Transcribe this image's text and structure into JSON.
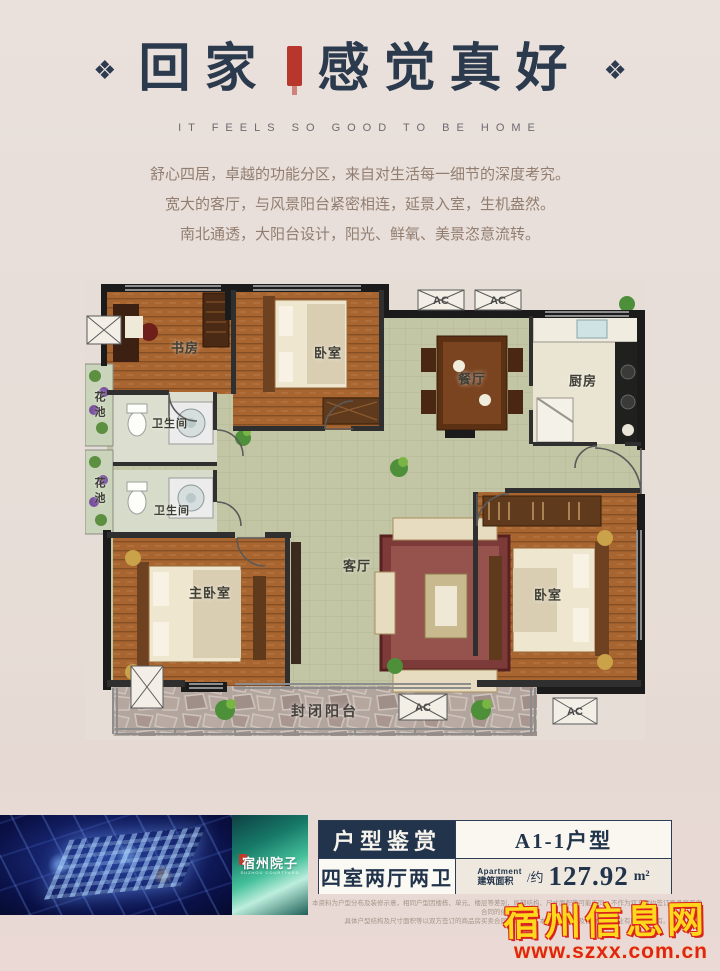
{
  "header": {
    "ornament": "❖",
    "title_left": "回家",
    "title_right": "感觉真好",
    "subtitle": "IT FEELS SO GOOD TO BE HOME"
  },
  "intro": {
    "lines": [
      "舒心四居，卓越的功能分区，来自对生活每一细节的深度考究。",
      "宽大的客厅，与风景阳台紧密相连，延景入室，生机盎然。",
      "南北通透，大阳台设计，阳光、鲜氧、美景恣意流转。"
    ]
  },
  "plan": {
    "ac_label": "AC",
    "rooms": [
      {
        "id": "study",
        "label": "书房"
      },
      {
        "id": "bedroom-top",
        "label": "卧室"
      },
      {
        "id": "dining",
        "label": "餐厅"
      },
      {
        "id": "kitchen",
        "label": "厨房"
      },
      {
        "id": "flower-pond-1",
        "label": "花池"
      },
      {
        "id": "bathroom-1",
        "label": "卫生间"
      },
      {
        "id": "flower-pond-2",
        "label": "花池"
      },
      {
        "id": "bathroom-2",
        "label": "卫生间"
      },
      {
        "id": "master-bedroom",
        "label": "主卧室"
      },
      {
        "id": "living",
        "label": "客厅"
      },
      {
        "id": "bedroom-right",
        "label": "卧室"
      },
      {
        "id": "balcony",
        "label": "封闭阳台"
      }
    ]
  },
  "footer": {
    "brand": {
      "name": "宿州院子",
      "caption": "SUZHOU COURTYARD"
    },
    "table": {
      "section_title": "户型鉴赏",
      "unit_type": "A1-1户型",
      "rooms_desc": "四室两厅两卫",
      "area_en": "Apartment",
      "area_cn": "建筑面积",
      "area_sep": "/约",
      "area_value": "127.92",
      "area_unit": "m²"
    },
    "disclaimer": [
      "本资料为户型分布及装修示意，相同户型因楼栋、单元、楼层等差别，局部结构、尺寸面积等可能不同，不作为双方履约签订商品房买卖合同的依据条款。",
      "具体户型结构及尺寸面积等以双方签订的商品房买卖合同约定为准，本资料解释权及修改权归置业有限公司所有。"
    ]
  },
  "watermark": {
    "site_name": "宿州信息网",
    "site_url": "www.szxx.com.cn"
  },
  "colors": {
    "accent_navy": "#22344b",
    "seal_red": "#b8372c",
    "watermark_yellow": "#ffd71c",
    "watermark_red": "#e2231a"
  }
}
